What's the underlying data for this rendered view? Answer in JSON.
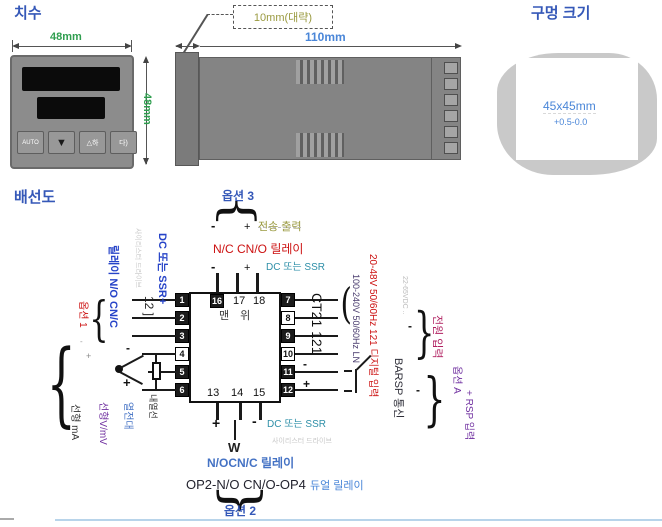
{
  "dims": {
    "title": "치수",
    "front": {
      "width_label": "48mm",
      "height_label": "48mm",
      "buttons": [
        "AUTO",
        "▼",
        "△하",
        "다)"
      ]
    },
    "side": {
      "depth_note": "10mm(대략)",
      "length_label": "110mm"
    }
  },
  "hole": {
    "title": "구멍 크기",
    "size_label": "45x45mm",
    "tolerance_label": "+0.5-0.0"
  },
  "wiring": {
    "title": "배선도",
    "model": "CT21 121",
    "top_label": "맨 위",
    "terminals": {
      "left": [
        "1",
        "2",
        "3",
        "4",
        "5",
        "6"
      ],
      "right": [
        "7",
        "8",
        "9",
        "10",
        "11",
        "12"
      ],
      "top": [
        "16",
        "17",
        "18"
      ],
      "bottom": [
        "13",
        "14",
        "15"
      ]
    },
    "opt3": {
      "label": "옵션 3",
      "minus": "-",
      "plus": "+",
      "transfer": "전송 출력",
      "relay": "N/C CN/O 릴레이",
      "dc_ssr": "DC 또는 SSR"
    },
    "left": {
      "opt1": "옵션 1",
      "relay": "릴레이 N/O CN/C",
      "thyristor": "사이리스터 드라이브",
      "bracket": "12 ]",
      "dc_ssr": "DC 또는 SSR+",
      "minus_mark": "-",
      "plus_mark": "+"
    },
    "sensor": {
      "minus": "-",
      "plus": "+",
      "labels": [
        "선형 mA",
        "선형V/mV",
        "열전대",
        "내열선"
      ]
    },
    "bottom": {
      "plus": "+",
      "minus": "-",
      "dc_ssr": "DC 또는 SSR",
      "thyristor": "사이리스터 드라이브",
      "load": "W",
      "relay": "N/OCN/C 릴레이",
      "op": "OP2-N/O CN/O-OP4",
      "dual": "듀얼 릴레이",
      "opt2": "옵션 2"
    },
    "right": {
      "mains": "100-240V 50/60Hz LN",
      "supply": "20-48V 50/60Hz 121 디지털 입력",
      "dc_note": "22-65VDC ..",
      "comm": "BARSP 통신",
      "power": "전원 입력",
      "optA": "옵션 A",
      "rsp": "+ RSP 입력",
      "minus": "-",
      "plus": "+"
    }
  },
  "glyphs": {
    "brace_left": "{",
    "brace_right": "}",
    "paren": "("
  },
  "colors": {
    "title_blue": "#3558b8",
    "dim_green": "#2f9e4f",
    "length_blue": "#4a86d8",
    "label_red": "#cc1111",
    "label_teal": "#2e8fa8",
    "label_purple": "#7030a0",
    "note_olive": "#9a9a40",
    "mains_dark_purple": "#4a3c6e",
    "body_gray": "#848484",
    "divider_blue": "#b8d4ea"
  }
}
